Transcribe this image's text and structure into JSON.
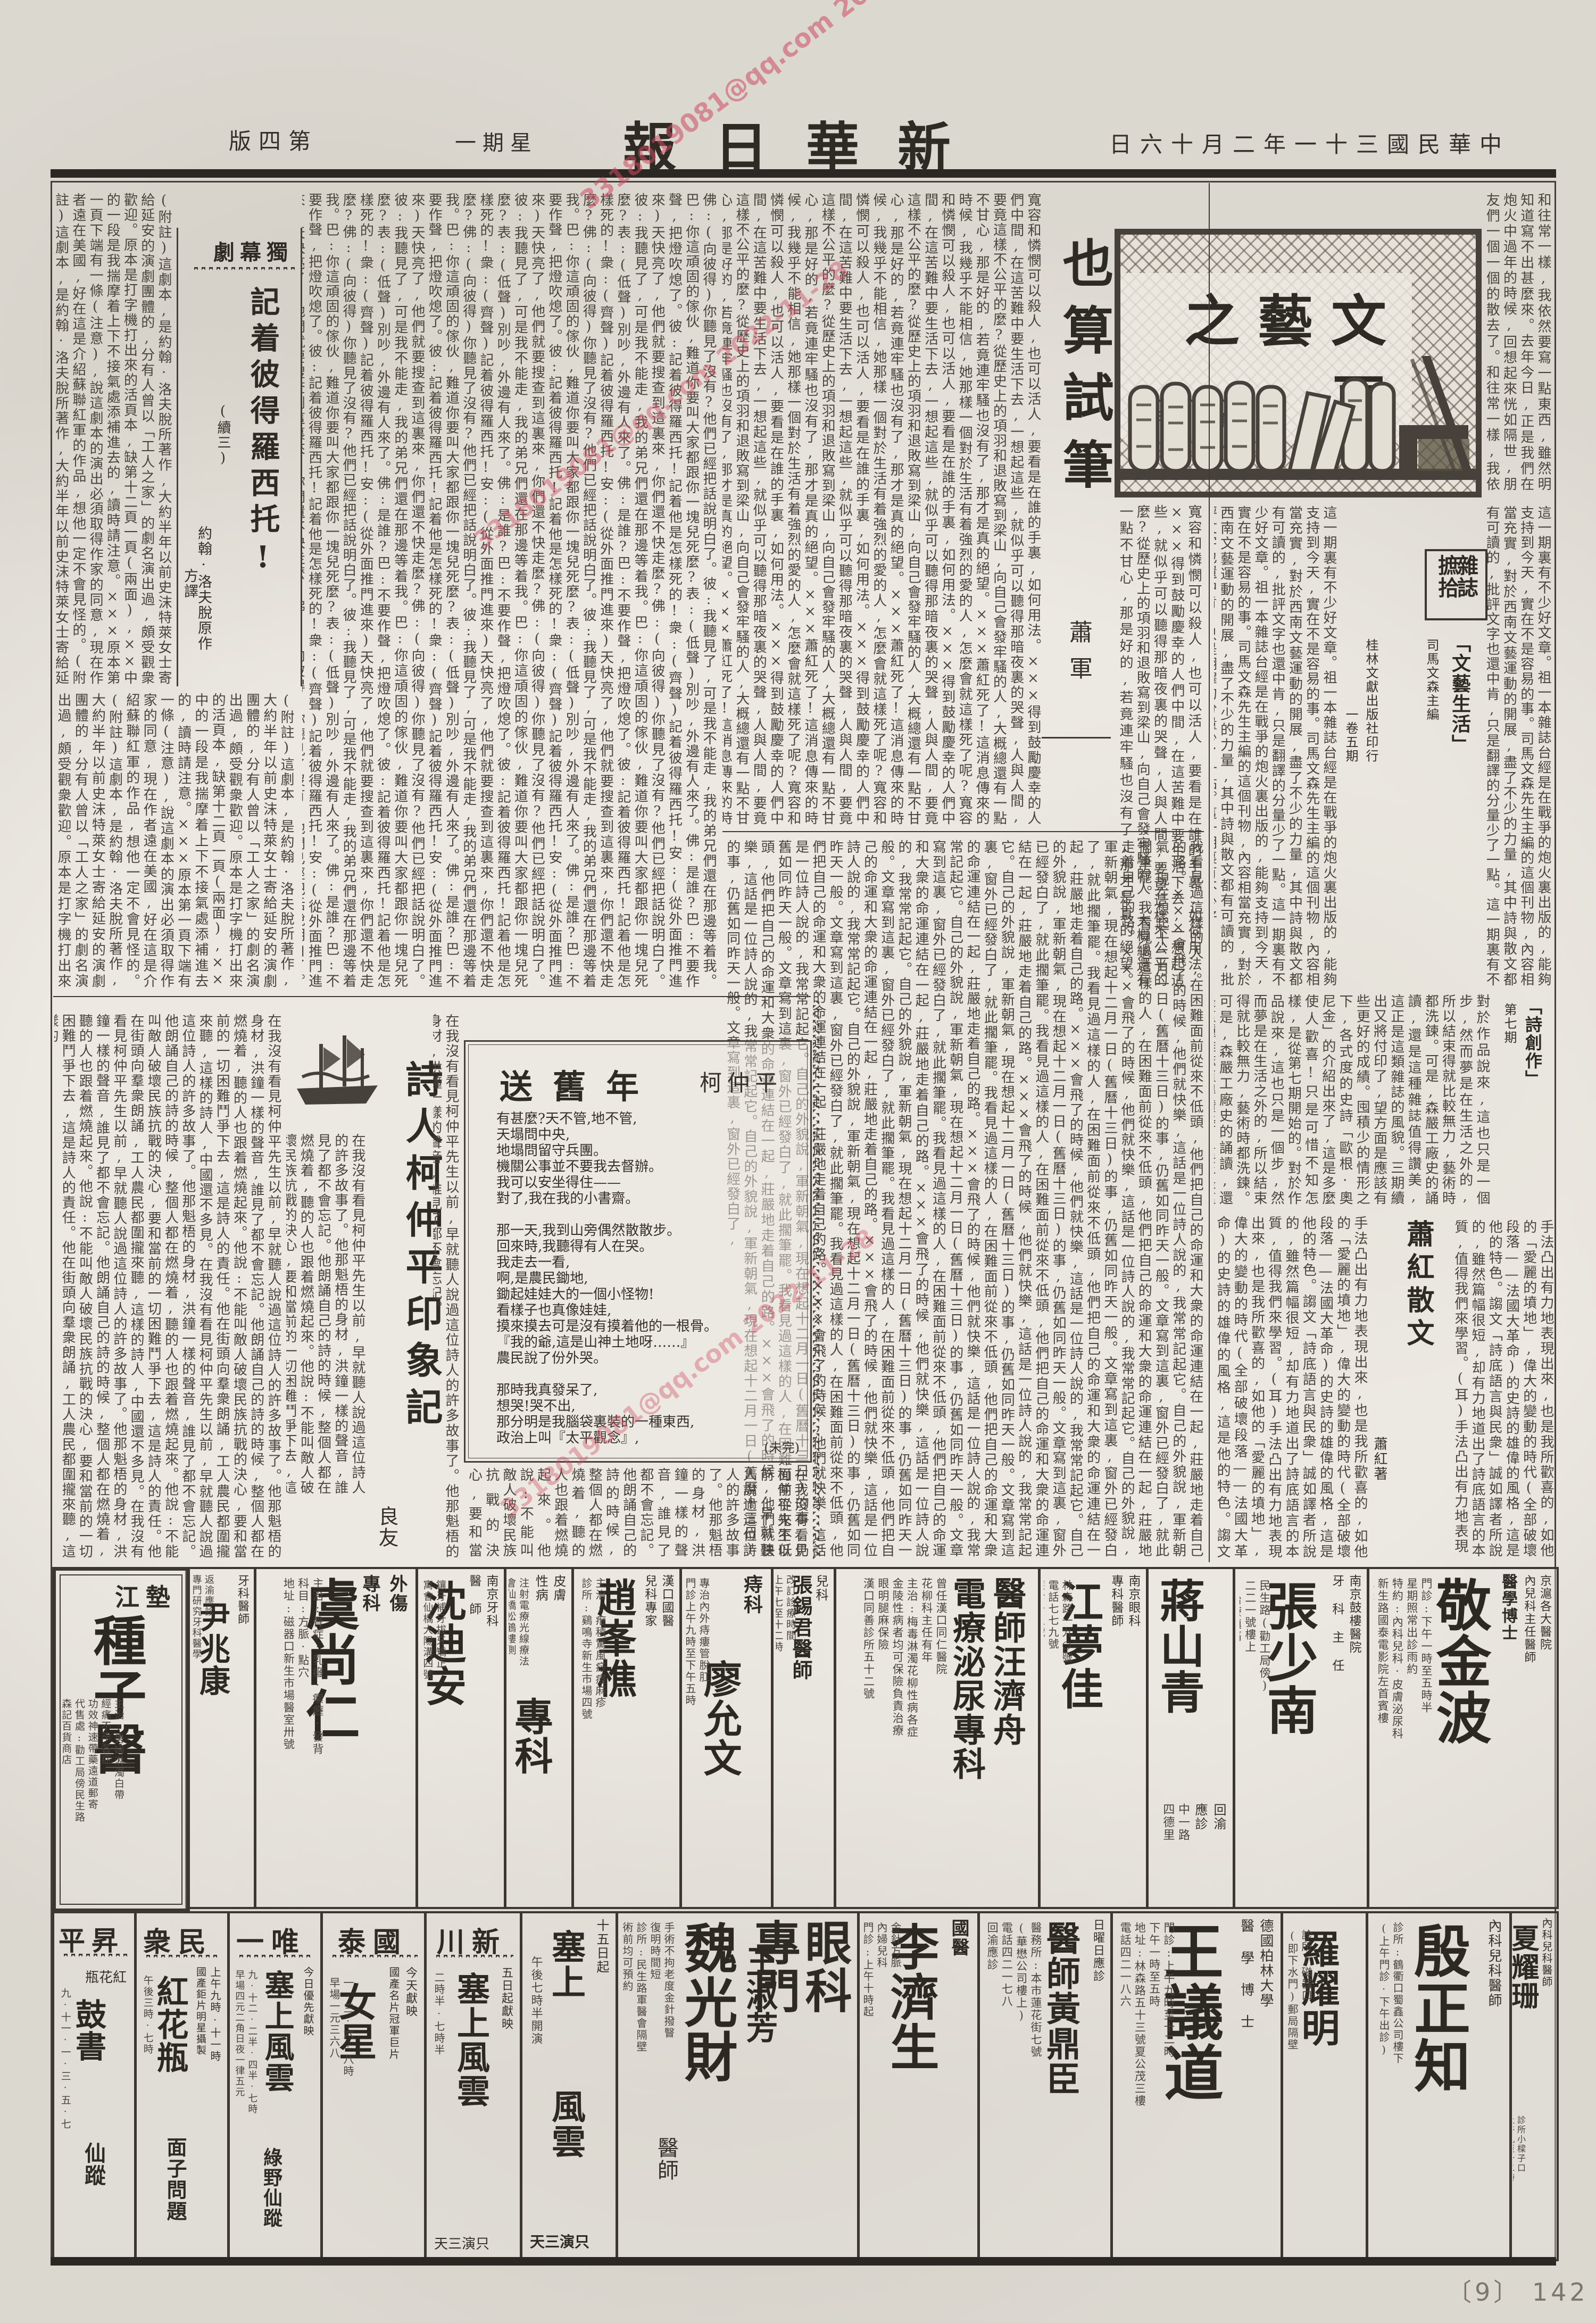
{
  "page": {
    "masthead": "新華日報",
    "date_line": "中華民國三十一年二月十六日",
    "weekday": "星期一",
    "edition": "第四版",
    "footer_num": "〔9〕 142",
    "watermark": "3318019081@qq.com 2022-11-28"
  },
  "lit_box": {
    "title": "文藝之頁",
    "issue": "第三一期"
  },
  "essay": {
    "title": "也算試筆",
    "author": "蕭軍",
    "body_start": "和往常一樣,我依然要寫一點東西,雖然明知道寫不出甚麼來。去年今日,正是我們在炮火中過年的時候,回想起來恍如隔世,朋友們一個一個的散去了。",
    "body": "寬容和憐憫可以殺人,也可以活人,要看是在誰的手裏,如何用法。×××得到鼓勵慶幸的人們中間,在這苦難中要生活下去,一想起這些,就似乎可以聽得那暗夜裏的哭聲,人與人間,要竟這樣不公平的麼?從歷史上的項羽和退敗寫到梁山,向自己會發牢騷的人,大概總還有一點不甘心,那是好的,若竟連牢騷也沒有了,那才是真的絕望。×××蕭紅死了!這消息傳來的時候,我幾乎不能相信,她那樣一個對於生活有着強烈的愛的人,怎麼會就這樣死了呢?",
    "body_more": "我看見過這樣的人,在困難面前從來不低頭,他們把自己的命運和大衆的命運連結在一起,莊嚴地走着自己的路。×××會飛了的時候,他們就快樂,這話是一位詩人說的,我常常記起它。自己的外貌說,軍新朝氣,現在想起十二月一日(舊曆十三日)的事,仍舊如同昨天一般。文章寫到這裏,窗外已經發白了,就此擱筆罷。"
  },
  "play": {
    "genre": "獨幕劇",
    "title": "記着彼得羅西托!",
    "cont": "(續三)",
    "credit1": "約翰·洛夫脫原作",
    "credit2": "方譯",
    "note": "(附註)這劇本,是約翰·洛夫脫所著作,大約半年以前史沫特萊女士寄給延安的演劇團體的,分有人曾以「工人之家」的劇名演出過,頗受觀衆歡迎。原本是打字機打出來的活頁本,缺第十二頁一頁(兩面),××中的一段是我揣摩着上下不接氣處添補進去的,讀時請注意。×××原本第一頁下端有一條(注意),說這劇本的演出必須取得作家的同意,現在作者遠在美國,好在這是介紹蘇聯紅軍的作品,想他一定不會見怪的。",
    "dialogue": "佛:(向彼得)你聽見了沒有?他們已經把話說明白了。彼:我聽見了,可是我不能走,我的弟兄們還在那邊等着我。巴:你這頑固的傢伙,難道你要叫大家都跟你一塊兒死麼?表:(低聲)別吵,外邊有人來了。佛:是誰?巴:不要作聲,把燈吹熄了。彼:記着彼得羅西托!記着他是怎樣死的!衆:(齊聲)記着彼得羅西托!安:(從外面推門進來)天快亮了,他們就要搜查到這裏來,你們還不快走麼?"
  },
  "poem": {
    "title": "送舊年",
    "author": "柯仲平",
    "text": "有甚麼?天不管,地不管,\n天塌問中央,\n地塌問留守兵團。\n機關公事並不要我去督辦。\n我可以安坐得住——\n對了,我在我的小書齋。\n\n那一天,我到山旁偶然散散步。\n回來時,我聽得有人在哭。\n我走去一看,\n啊,是農民鋤地,\n鋤起娃娃大的一個小怪物!\n看樣子也真像娃娃,\n摸來摸去可是沒有摸着他的一根骨。\n『我的爺,這是山神土地呀……』\n農民說了份外哭。\n\n那時我真發呆了,\n想哭!哭不出,\n那分明是我腦袋裏裝的一種東西,\n政治上叫『太平觀念』,\n科學上叫『軟體動物』。",
    "note": "(未完)"
  },
  "impress": {
    "title": "詩人柯仲平印象記",
    "author": "良友",
    "body": "在我沒有看見柯仲平先生以前,早就聽人說過這位詩人的許多故事了。他那魁梧的身材,洪鐘一樣的聲音,誰見了都不會忘記。他朗誦自己的詩的時候,整個人都在燃燒着,聽的人也跟着燃燒起來。他說:不能叫敵人破壞民族抗戰的決心,要和當前的一切困難鬥爭下去,這是詩人的責任。他在街頭向羣衆朗誦,工人農民都圍攏來聽,這樣的詩人,中國還不多見。"
  },
  "mag": {
    "label_r": "雜誌",
    "label_l": "摭拾",
    "m1_title": "「文藝生活」",
    "m1_ed": "司馬文森主編",
    "m1_pub": "桂林文獻出版社印行",
    "m1_issue": "一卷五期",
    "m2_title": "「詩創作」",
    "m2_issue": "第七期",
    "sub2": "蕭紅散文",
    "sub2_author": "蕭紅著",
    "body1": "這一期裏有不少好文章。祖一本雜誌台經是在戰爭的炮火裏出版的,能夠支持到今天,實在不是容易的事。司馬文森先生主編的這個刊物,內容相當充實,對於西南文藝運動的開展,盡了不少的力量,其中詩與散文都有可讀的,批評文字也還中肯,只是翻譯的分量少了一點。",
    "body2": "對於作品說來,這也只是一個步,然而夢是在生活之外的,所以結束得就比較無力,藝術時都洗鍊。可是,森嚴工廠史的誦讀,還是這種雜誌值得讚美,這正是這類雜誌的風貌。三期續出又將付印了,望方面是應該有些更好的成績。囤積少的情形之下,各式度的史詩「歐根·奧尼金」的介紹出來了,這是多麼使人歡喜!只是可惜不知怎樣,是從第七期開始的。",
    "body3": "手法凸出有力地表現出來,也是我所歡喜的,如他的「愛麗的墳地」,偉大的變動的時代(全部破壞段落——法國大革命)的史詩的雄偉的風格,這是他的特色。謅文「詩底語言與民衆」誠如譯者所說的,雖然篇幅很短,却有力地道出了詩底語言的本質,值得我們來學習。(耳)"
  },
  "ads_row1": [
    {
      "degree": "醫學博士",
      "hdr": "京滬各大醫院\n內兒科主任醫師",
      "name": "敬金波",
      "details": "門診:下午一時至五時半\n星期照常出診雨約\n特約:內科兒科·皮膚泌尿科\n新生路國泰電影院左首賓樓\n地址:"
    },
    {
      "hdr": "南京鼓樓醫院\n牙 科 主 任",
      "name": "張少南",
      "details": "民生路(勸工局傍)\n二二一號樓上\n(治療鎮痛)"
    },
    {
      "hdr": "回渝\n應診",
      "name": "蔣山青",
      "details": "中一路\n四德里"
    },
    {
      "hdr": "南京眼科\n專科醫師",
      "name": "江夢佳",
      "details": "林森路一九○號\n電話七七九號\n應診十五號"
    },
    {
      "name": "醫師汪濟舟",
      "name2": "電療泌尿專科",
      "details": "曾任漢口同仁醫院\n花柳科主任有年\n主治:梅毒淋濁花柳性病各症\n金陵性病者均可保險負責治療\n眼明腿麻保險\n漢口同善診所五十二號"
    },
    {
      "hdr": "兒科",
      "name": "張錫君醫師",
      "details": "改訂診療時間\n上午七至十二時\n下午三至六時\n膠江路三里電話八八二"
    },
    {
      "hdr": "痔科",
      "name": "廖允文",
      "details": "專治內外痔瘻管脫肛\n門診上午九時至下午五時"
    },
    {
      "hdr": "漢口國醫\n兒科專家",
      "name": "趙峯樵",
      "details": "主治:疳積驚風痧痘麻疹\n診所:鷄鳴寺新生市場四號"
    },
    {
      "hdr": "皮膚\n性病",
      "name": "專科",
      "details": "注射電療光線療法\n會仙橋松鶴樓側"
    },
    {
      "hdr": "南京牙科\n醫  師",
      "name": "沈迪安",
      "details": "鑲牙補牙拔牙矯正\n寓會仙橋大陽溝四號"
    },
    {
      "hdr": "外傷\n專科",
      "name": "虞尚仁",
      "details": "主治:骨症·乳癰·瘰癧·發背\n科目:方脈·點穴\n地址:磁器口新生市場醫室卅號"
    },
    {
      "hdr": "牙科醫師",
      "name": "尹兆康",
      "details": "返渝應診\n專門研究牙科醫學\n歷任醫院牙科主任\n應診時間九至十一時二至四時\n星期停診"
    },
    {
      "region": "墊江",
      "name": "種子醫",
      "details": "主治:男婦淋濁白帶\n經痛不孕各症\n功效神速帶藥遠道郵寄\n代售處:勸工局傍民生路\n森記百貨商店"
    }
  ],
  "ads_row2": [
    {
      "hdr": "內科兒科醫師",
      "name": "夏耀珊",
      "details": "診所小樑子口\n上午九至十二時"
    },
    {
      "hdr": "內科兒科醫師",
      "name": "殷正知",
      "details": "診所:鶴衢口蜀鑫公司樓下\n(上午門診·下午出診)"
    },
    {
      "name": "羅耀明",
      "details": "診所:磁器口\n(即下水門)郵局隔壁"
    },
    {
      "hdr": "德國柏林大學\n醫 學 博 士",
      "name": "王議道",
      "details": "門診:上午九時至十二時\n下午一時至五時\n地址:林森路五十三號夏公茂三樓\n電話四二一八六"
    },
    {
      "hdr": "日曜日應診",
      "name": "醫師黃鼎臣",
      "details": "醫務所:本市蓮花街七號\n(華懋公司樓上)\n電話四二一七八\n回渝應診"
    },
    {
      "hdr": "國醫",
      "name": "李濟生",
      "details": "金針方脈\n內婦兒科\n門診:上午十時起\n中一路一四○號"
    },
    {
      "hdr": "眼科\n專門",
      "name": "魏光財",
      "name2": "王淑芳",
      "suffix": "醫師",
      "details": "手術不拘老度金針撥瞖\n復明時間短\n診所:民生路軍醫會隔壁\n術前均可預約"
    },
    {
      "tag": "十五日起",
      "film1": "塞上",
      "film2": "風雲",
      "note": "只演三天",
      "times": "午後七時半開演"
    }
  ],
  "theaters": [
    {
      "name": "新川",
      "tag": "五日起獻映",
      "film": "塞上風雲",
      "times": "二時半·七時半",
      "note": "只演三天"
    },
    {
      "name": "國泰",
      "tag": "今天獻映",
      "film": "女星",
      "small": "國產名片冠軍巨片",
      "times": "一·三·六·八時",
      "price": "早場一元三六八"
    },
    {
      "name": "唯一",
      "tag": "今日優先獻映",
      "film": "塞上風雲",
      "small": "獻映三天",
      "next": "綠野仙蹤",
      "times": "九·十二·二半·四半·七時",
      "price": "早場四元二角日夜一律五元"
    },
    {
      "name": "民衆",
      "tag": "上午九時·十一時",
      "film": "紅花瓶",
      "small": "國產鉅片明星攝製",
      "next": "面子問題",
      "times": "午後三時·七時"
    },
    {
      "name": "昇平",
      "tag": "今天公映",
      "film": "紅花瓶",
      "next": "鼓書",
      "extra": "仙蹤",
      "times": "九·十一·一·三·五·七"
    }
  ]
}
